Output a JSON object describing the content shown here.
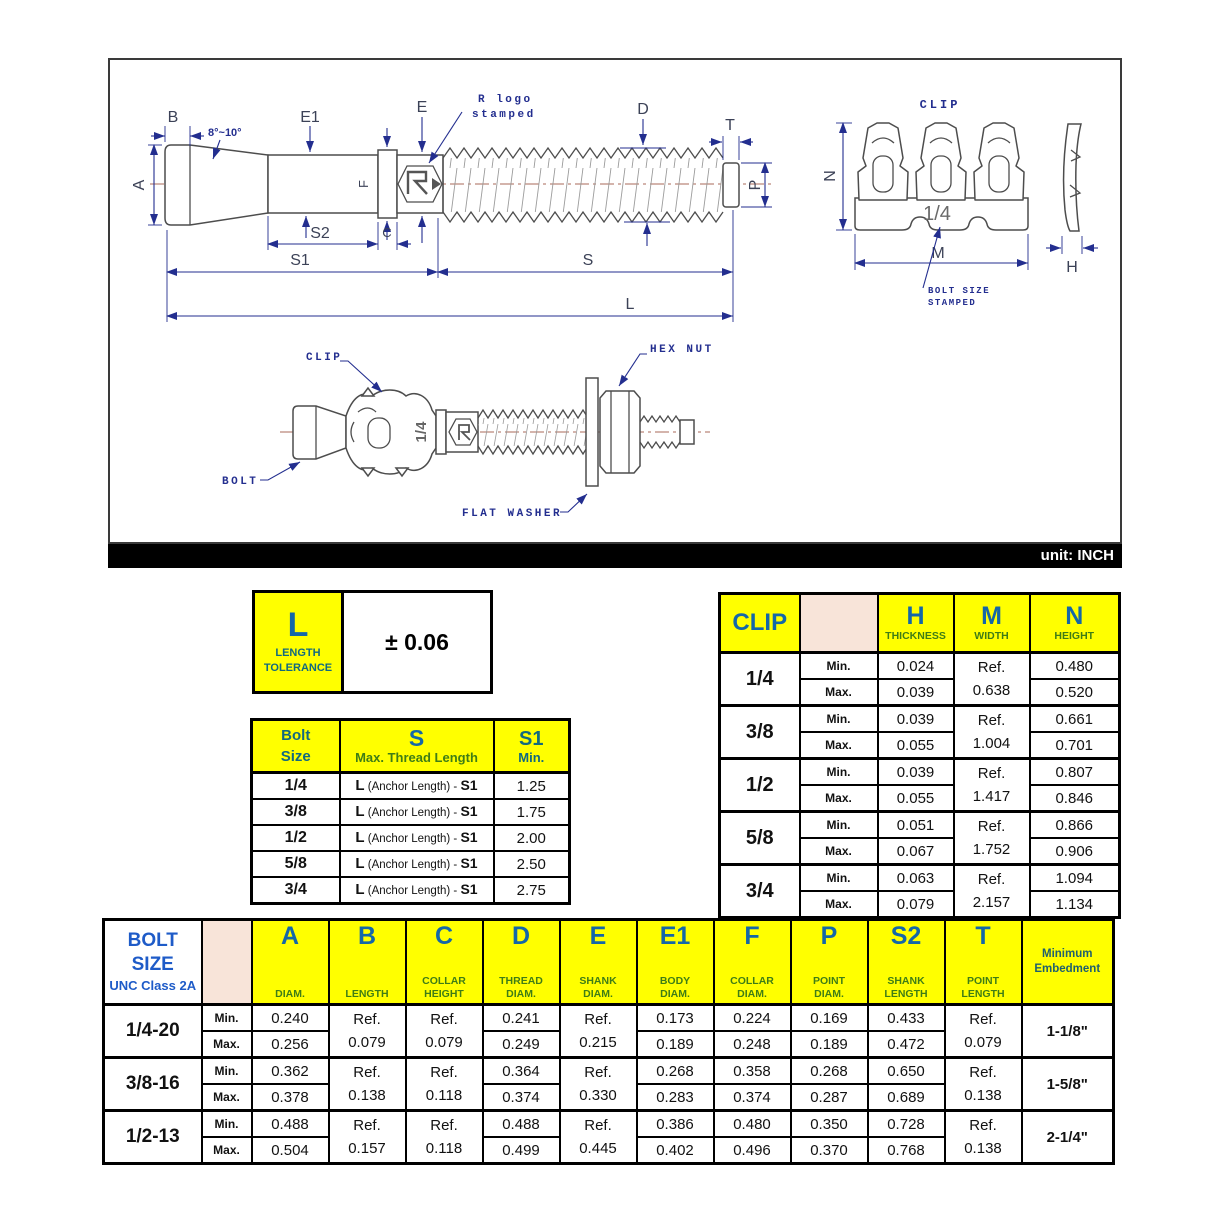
{
  "unit_label": "unit: INCH",
  "colors": {
    "accent_yellow": "#ffff00",
    "peach_cell": "#f8e4d9",
    "header_letter_blue": "#1467a8",
    "header_sub_green": "#3f7d16",
    "teal_header": "#12697f",
    "bolt_size_blue": "#1e5bc8",
    "embed_header_teal": "#1e5f6e",
    "annotation_navy": "#232e8f",
    "centerline_brown": "#a86a58"
  },
  "drawing": {
    "dims": {
      "B": "B",
      "angle": "8°~10°",
      "E1": "E1",
      "E": "E",
      "D": "D",
      "T": "T",
      "A": "A",
      "F": "F",
      "P": "P",
      "S2": "S2",
      "C": "C",
      "S1": "S1",
      "S": "S",
      "L": "L",
      "N": "N",
      "M": "M",
      "H": "H"
    },
    "notes": {
      "r_logo_1": "R logo",
      "r_logo_2": "stamped",
      "clip_title": "CLIP",
      "bolt_size_1": "BOLT SIZE",
      "bolt_size_2": "STAMPED",
      "stamp": "1/4"
    },
    "assembly": {
      "clip": "CLIP",
      "bolt": "BOLT",
      "hex_nut": "HEX NUT",
      "flat_washer": "FLAT WASHER",
      "stamp": "1/4"
    }
  },
  "tolerance_table": {
    "symbol": "L",
    "label1": "LENGTH",
    "label2": "TOLERANCE",
    "value": "± 0.06"
  },
  "thread_table": {
    "header": {
      "col1a": "Bolt",
      "col1b": "Size",
      "col2": "S",
      "col2sub": "Max. Thread Length",
      "col3": "S1",
      "col3sub": "Min."
    },
    "formula": {
      "pre": "L",
      "mid": " (Anchor Length) - ",
      "post": "S1"
    },
    "rows": [
      {
        "size": "1/4",
        "min": "1.25"
      },
      {
        "size": "3/8",
        "min": "1.75"
      },
      {
        "size": "1/2",
        "min": "2.00"
      },
      {
        "size": "5/8",
        "min": "2.50"
      },
      {
        "size": "3/4",
        "min": "2.75"
      }
    ]
  },
  "clip_table": {
    "title": "CLIP",
    "min": "Min.",
    "max": "Max.",
    "ref": "Ref.",
    "cols": {
      "h": "H",
      "h_sub": "THICKNESS",
      "m": "M",
      "m_sub": "WIDTH",
      "n": "N",
      "n_sub": "HEIGHT"
    },
    "rows": [
      {
        "size": "1/4",
        "h_min": "0.024",
        "h_max": "0.039",
        "m_ref": "0.638",
        "n_min": "0.480",
        "n_max": "0.520"
      },
      {
        "size": "3/8",
        "h_min": "0.039",
        "h_max": "0.055",
        "m_ref": "1.004",
        "n_min": "0.661",
        "n_max": "0.701"
      },
      {
        "size": "1/2",
        "h_min": "0.039",
        "h_max": "0.055",
        "m_ref": "1.417",
        "n_min": "0.807",
        "n_max": "0.846"
      },
      {
        "size": "5/8",
        "h_min": "0.051",
        "h_max": "0.067",
        "m_ref": "1.752",
        "n_min": "0.866",
        "n_max": "0.906"
      },
      {
        "size": "3/4",
        "h_min": "0.063",
        "h_max": "0.079",
        "m_ref": "2.157",
        "n_min": "1.094",
        "n_max": "1.134"
      }
    ]
  },
  "bolt_table": {
    "title1": "BOLT",
    "title2": "SIZE",
    "title3": "UNC Class 2A",
    "min": "Min.",
    "max": "Max.",
    "ref": "Ref.",
    "cols": [
      {
        "sym": "A",
        "sub1": "",
        "sub2": "DIAM."
      },
      {
        "sym": "B",
        "sub1": "",
        "sub2": "LENGTH"
      },
      {
        "sym": "C",
        "sub1": "COLLAR",
        "sub2": "HEIGHT"
      },
      {
        "sym": "D",
        "sub1": "THREAD",
        "sub2": "DIAM."
      },
      {
        "sym": "E",
        "sub1": "SHANK",
        "sub2": "DIAM."
      },
      {
        "sym": "E1",
        "sub1": "BODY",
        "sub2": "DIAM."
      },
      {
        "sym": "F",
        "sub1": "COLLAR",
        "sub2": "DIAM."
      },
      {
        "sym": "P",
        "sub1": "POINT",
        "sub2": "DIAM."
      },
      {
        "sym": "S2",
        "sub1": "SHANK",
        "sub2": "LENGTH"
      },
      {
        "sym": "T",
        "sub1": "POINT",
        "sub2": "LENGTH"
      },
      {
        "sym": "",
        "sub1": "Minimum",
        "sub2": "Embedment"
      }
    ],
    "rows": [
      {
        "size": "1/4-20",
        "a_min": "0.240",
        "a_max": "0.256",
        "b_ref": "0.079",
        "c_ref": "0.079",
        "d_min": "0.241",
        "d_max": "0.249",
        "e_ref": "0.215",
        "e1_min": "0.173",
        "e1_max": "0.189",
        "f_min": "0.224",
        "f_max": "0.248",
        "p_min": "0.169",
        "p_max": "0.189",
        "s2_min": "0.433",
        "s2_max": "0.472",
        "t_ref": "0.079",
        "embed": "1-1/8\""
      },
      {
        "size": "3/8-16",
        "a_min": "0.362",
        "a_max": "0.378",
        "b_ref": "0.138",
        "c_ref": "0.118",
        "d_min": "0.364",
        "d_max": "0.374",
        "e_ref": "0.330",
        "e1_min": "0.268",
        "e1_max": "0.283",
        "f_min": "0.358",
        "f_max": "0.374",
        "p_min": "0.268",
        "p_max": "0.287",
        "s2_min": "0.650",
        "s2_max": "0.689",
        "t_ref": "0.138",
        "embed": "1-5/8\""
      },
      {
        "size": "1/2-13",
        "a_min": "0.488",
        "a_max": "0.504",
        "b_ref": "0.157",
        "c_ref": "0.118",
        "d_min": "0.488",
        "d_max": "0.499",
        "e_ref": "0.445",
        "e1_min": "0.386",
        "e1_max": "0.402",
        "f_min": "0.480",
        "f_max": "0.496",
        "p_min": "0.350",
        "p_max": "0.370",
        "s2_min": "0.728",
        "s2_max": "0.768",
        "t_ref": "0.138",
        "embed": "2-1/4\""
      }
    ]
  }
}
